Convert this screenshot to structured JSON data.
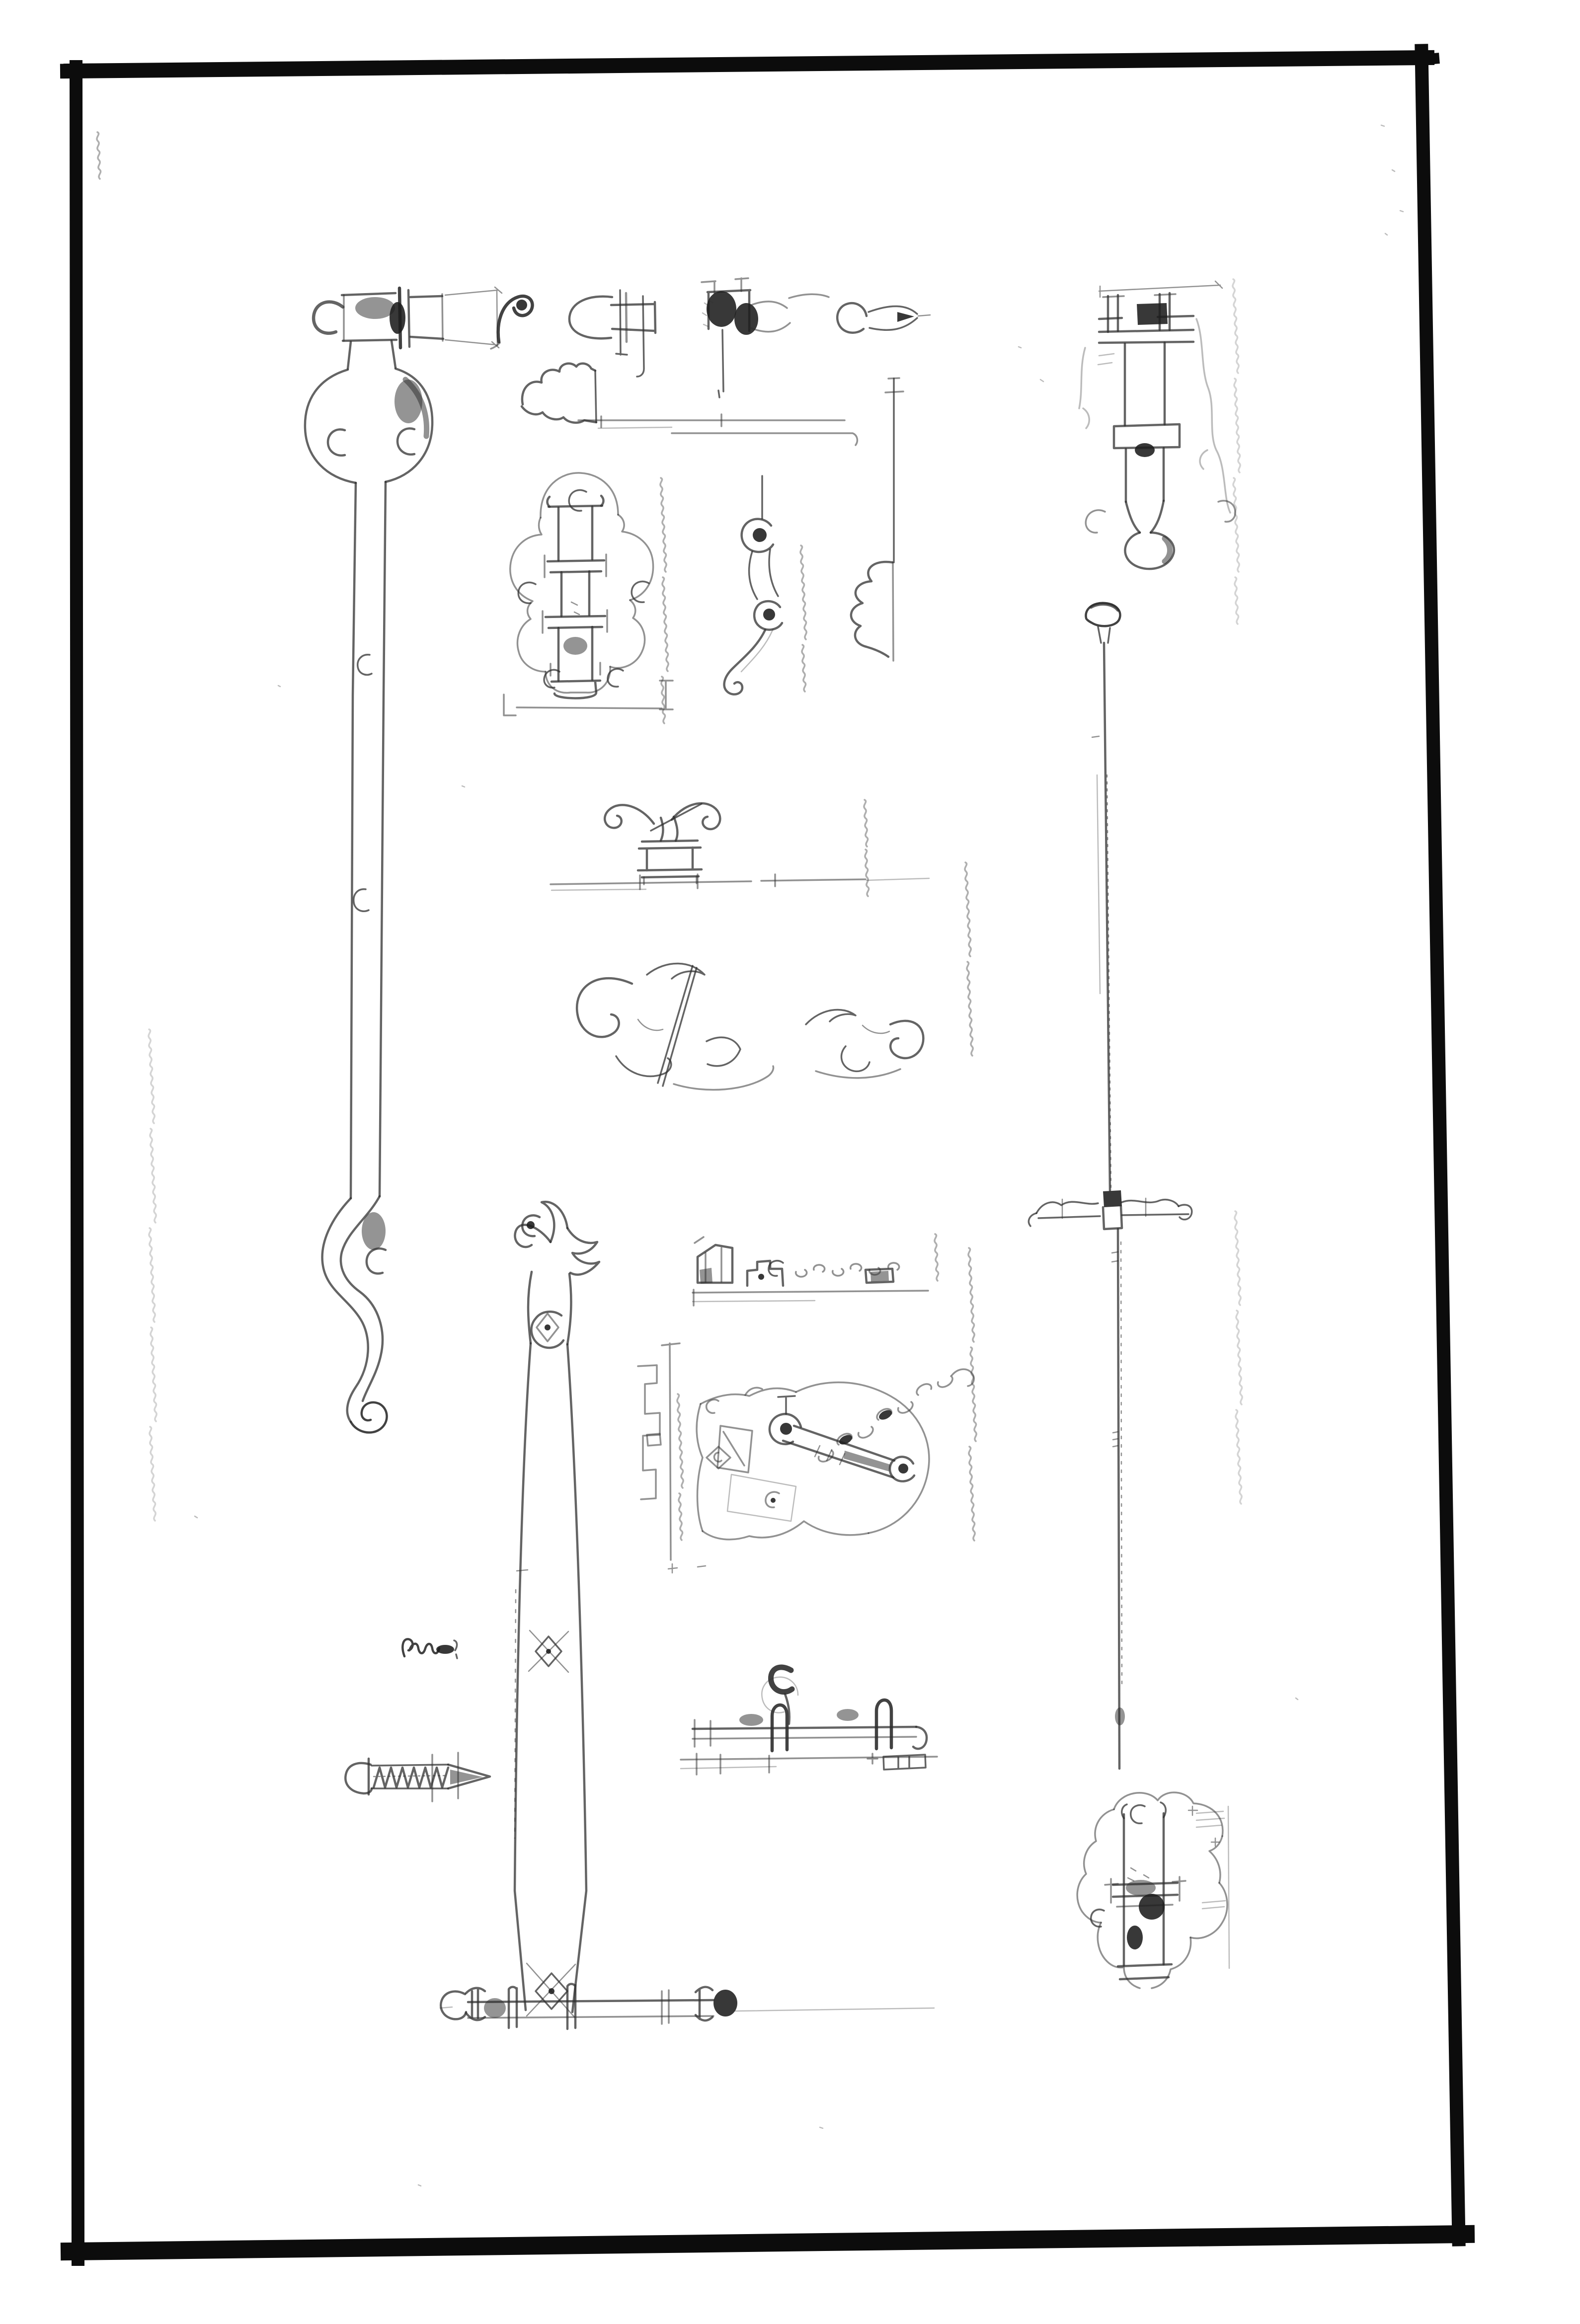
{
  "page": {
    "description": "Scanned plate of faint hand-drawn wrought-iron door hardware studies (bolts, latches, straps, screws) inside a thick hand-ruled black rectangular frame on white paper",
    "paper_color": "#ffffff",
    "frame_ink_color": "#0c0c0c",
    "sketch_ink_color": "#2e2e2e",
    "annotation_note": "faint rotated handwritten notes, illegible in scan"
  },
  "figures": {
    "frame": {
      "label": "hand-ruled rectangular border frame"
    },
    "strap_bolt_left": {
      "label": "long vertical strap bolt with eye bracket, round back-plate and S-scroll terminal"
    },
    "scroll_handle": {
      "label": "small scrolled latch handle"
    },
    "latch_profile": {
      "label": "latch bar profile with round end plate and pins"
    },
    "latch_keeper_top": {
      "label": "inked latch keeper bracket with staple pin"
    },
    "ring_catch": {
      "label": "ring with pointed beak catch"
    },
    "moulding_profile": {
      "label": "beaded moulding section profile with base line"
    },
    "baluster_profile": {
      "label": "turned drop section with bead profile on vertical guide"
    },
    "barrel_bolt_plate": {
      "label": "vertical barrel bolt on scalloped quatrefoil plate"
    },
    "hook_latch": {
      "label": "hook latch with two eyes and scroll tail"
    },
    "scroll_handle_pedestal": {
      "label": "double-volute handle on moulded pedestal over door edge line"
    },
    "foliage_scrollwork": {
      "label": "foliage scrollwork studies"
    },
    "espagnolette_head": {
      "label": "espagnolette bolt head with brackets, drop knob and scalloped plate edge"
    },
    "espagnolette_rod": {
      "label": "long espagnolette rod with knob and scalloped keeper bar"
    },
    "bolt_plate_bottom_right": {
      "label": "vertical bolt channel on scalloped plate"
    },
    "tapered_strap": {
      "label": "tapered strap with scroll-and-flame top and diamond studs"
    },
    "latch_keeper_row": {
      "label": "latch keeper, lift piece, chain and staple in profile"
    },
    "thumb_latch": {
      "label": "thumb latch lever with pivot, eye and chain on shaped plate beside jamb section"
    },
    "latch_bar": {
      "label": "latch bar through staples with thumb lift and keep"
    },
    "hand_screw": {
      "label": "threaded screw with domed slotted head"
    },
    "written_note": {
      "label": "handwritten word (illegible)"
    },
    "bar_with_finials": {
      "label": "bar with turned ball finials and keeper staples"
    },
    "annotations": {
      "label": "faint handwritten margin notes (illegible)"
    },
    "specks": {
      "label": "paper specks and scan noise"
    }
  }
}
